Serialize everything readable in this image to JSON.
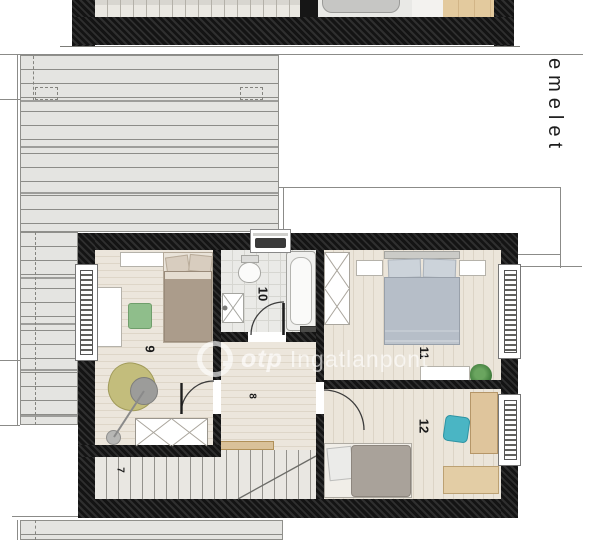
{
  "plan": {
    "floor_label": "emelet",
    "rooms": [
      {
        "number": "7"
      },
      {
        "number": "8"
      },
      {
        "number": "9"
      },
      {
        "number": "10"
      },
      {
        "number": "11"
      },
      {
        "number": "12"
      }
    ]
  },
  "watermark": {
    "brand": "otp",
    "text": "Ingatlanpont"
  },
  "colors": {
    "wall": "#1b1b1b",
    "floor_wood": "#ece6dc",
    "roof_gray": "#e4e4e1",
    "furniture_wood": "#dfc59c",
    "accent_teal": "#4ab5c4",
    "accent_green": "#8fbe8b",
    "accent_olive": "#c3bd7c",
    "bed_blue": "#b6bec8"
  }
}
